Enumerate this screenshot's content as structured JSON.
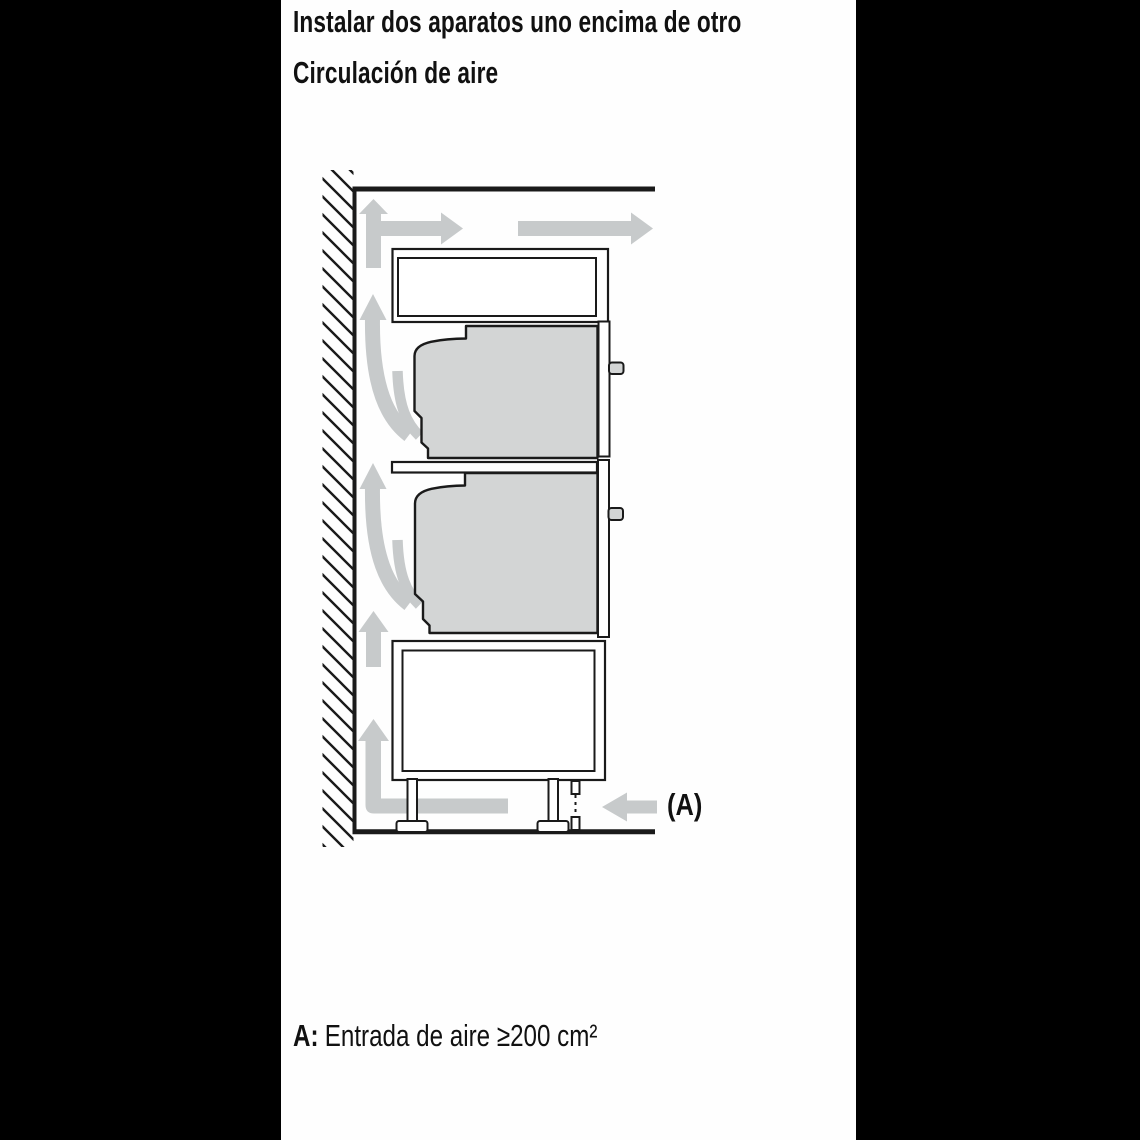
{
  "theme": {
    "page-bg": "#000000",
    "content-bg": "#fefefe",
    "text": "#111111",
    "outline": "#1a1a1a",
    "appliance-fill": "#d3d5d5",
    "panel-fill": "#ffffff",
    "arrow-fill": "#c7cacb"
  },
  "header": {
    "title": "Instalar dos aparatos uno encima de otro",
    "subtitle": "Circulación de aire"
  },
  "diagram": {
    "inlet_label": "(A)",
    "arrow_names": [
      "airflow-arrow-up-top",
      "airflow-arrow-right-inner",
      "airflow-arrow-right-outer",
      "airflow-arrow-curved-upper",
      "airflow-arrow-curved-lower",
      "airflow-arrow-up-middle",
      "airflow-arrow-floor-to-wall",
      "air-inlet-arrow"
    ]
  },
  "footnote": {
    "key": "A:",
    "text": "Entrada de aire ≥200 cm²"
  }
}
